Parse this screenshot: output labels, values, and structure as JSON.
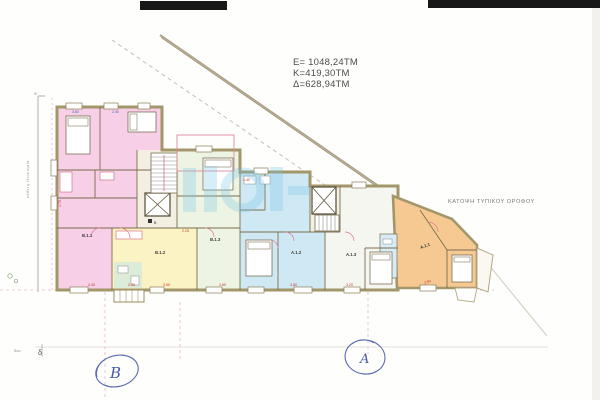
{
  "annotations": {
    "areas": [
      "E= 1048,24TM",
      "K=419,30TM",
      "Δ=628,94TM"
    ],
    "plan_title": "ΚΑΤΟΨΗ ΤΥΠΙΚΟΥ ΟΡΟΦΟΥ",
    "mark_b": "B",
    "mark_a": "A",
    "street_label": "κάθετη ιδιοκτησία",
    "psi": "Ψ",
    "axis_delta": "δ",
    "axis_small": "δου"
  },
  "stair_labels": {
    "left": "B",
    "right": "A"
  },
  "units": [
    {
      "label": "B.1.1",
      "color": "#f7cfe6"
    },
    {
      "label": "B.1.2",
      "color": "#fbf3c4"
    },
    {
      "label": "B.1.3",
      "color": "#edf4e4"
    },
    {
      "label": "A.1.2",
      "color": "#cfe9f4"
    },
    {
      "label": "A.1.3",
      "color": "#f5f6f0"
    },
    {
      "label": "A.1.1",
      "color": "#f6c993"
    }
  ],
  "dims": [
    "4.40",
    "2.05",
    "3.00",
    "2.60",
    "3.80",
    "3.20",
    "2.93",
    "1.40",
    "2.25",
    "4.70",
    "3.60",
    "2.40"
  ],
  "colors": {
    "wall_tan": "#a3966b",
    "pen_blue": "#5a68b0",
    "dim_red": "#c0392b",
    "dim_blue": "#3a5fa8",
    "watermark_blue": "#6fc4e8",
    "scan_bar": "#181818"
  }
}
